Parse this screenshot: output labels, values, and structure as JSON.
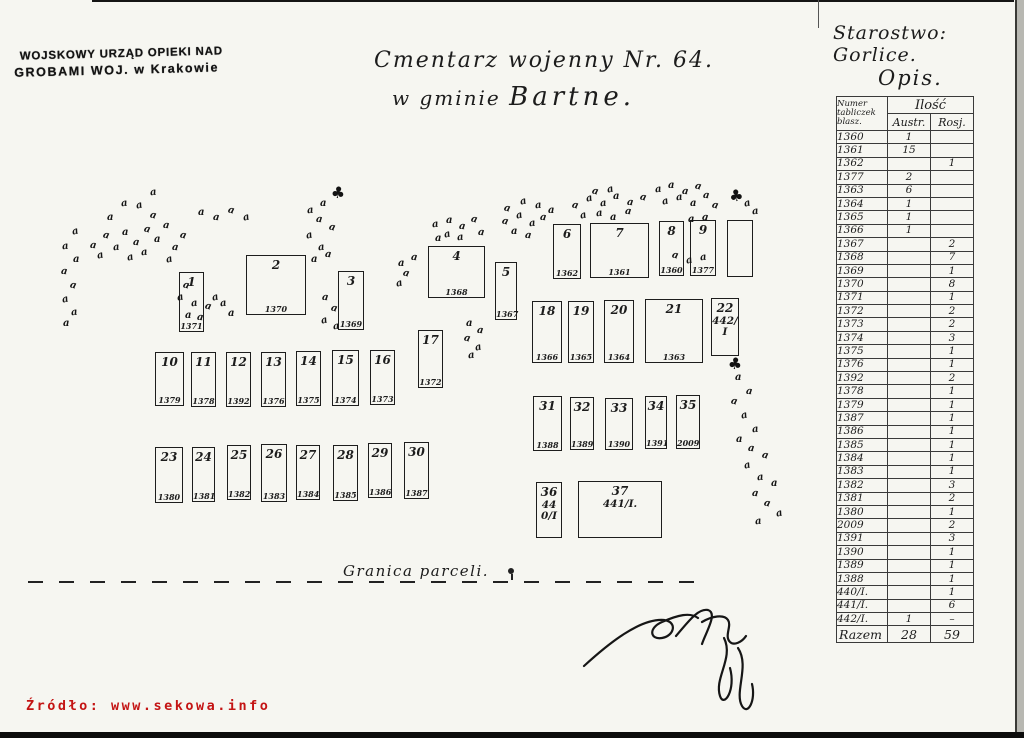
{
  "colors": {
    "paper": "#f6f6f1",
    "ink": "#1c1c1c",
    "accent_red": "#c41414"
  },
  "stamp": {
    "line1": "WOJSKOWY URZĄD OPIEKI NAD",
    "line2": "GROBAMI WOJ. w Krakowie"
  },
  "title": {
    "line1": "Cmentarz wojenny Nr. 64.",
    "line2_prefix": "w gminie",
    "line2_name": "Bartne."
  },
  "starostwo": "Starostwo: Gorlice.",
  "opis": {
    "label": "Opis.",
    "col_num": [
      "Numer",
      "tabliczek",
      "blasz."
    ],
    "col_ilosc": "Ilość",
    "col_austr": "Austr.",
    "col_ros": "Rosj.",
    "rows": [
      [
        "1360",
        "1",
        ""
      ],
      [
        "1361",
        "15",
        ""
      ],
      [
        "1362",
        "",
        "1"
      ],
      [
        "1377",
        "2",
        ""
      ],
      [
        "1363",
        "6",
        ""
      ],
      [
        "1364",
        "1",
        ""
      ],
      [
        "1365",
        "1",
        ""
      ],
      [
        "1366",
        "1",
        ""
      ],
      [
        "1367",
        "",
        "2"
      ],
      [
        "1368",
        "",
        "7"
      ],
      [
        "1369",
        "",
        "1"
      ],
      [
        "1370",
        "",
        "8"
      ],
      [
        "1371",
        "",
        "1"
      ],
      [
        "1372",
        "",
        "2"
      ],
      [
        "1373",
        "",
        "2"
      ],
      [
        "1374",
        "",
        "3"
      ],
      [
        "1375",
        "",
        "1"
      ],
      [
        "1376",
        "",
        "1"
      ],
      [
        "1392",
        "",
        "2"
      ],
      [
        "1378",
        "",
        "1"
      ],
      [
        "1379",
        "",
        "1"
      ],
      [
        "1387",
        "",
        "1"
      ],
      [
        "1386",
        "",
        "1"
      ],
      [
        "1385",
        "",
        "1"
      ],
      [
        "1384",
        "",
        "1"
      ],
      [
        "1383",
        "",
        "1"
      ],
      [
        "1382",
        "",
        "3"
      ],
      [
        "1381",
        "",
        "2"
      ],
      [
        "1380",
        "",
        "1"
      ],
      [
        "2009",
        "",
        "2"
      ],
      [
        "1391",
        "",
        "3"
      ],
      [
        "1390",
        "",
        "1"
      ],
      [
        "1389",
        "",
        "1"
      ],
      [
        "1388",
        "",
        "1"
      ],
      [
        "440/I.",
        "",
        "1"
      ],
      [
        "441/I.",
        "",
        "6"
      ],
      [
        "442/I.",
        "1",
        "–"
      ]
    ],
    "razem": [
      "Razem",
      "28",
      "59"
    ]
  },
  "map": {
    "granica": "Granica parceli.",
    "plots": [
      {
        "n": "1",
        "g": "1371",
        "x": 179,
        "y": 272,
        "w": 23,
        "h": 58
      },
      {
        "n": "2",
        "g": "1370",
        "x": 246,
        "y": 255,
        "w": 58,
        "h": 58
      },
      {
        "n": "3",
        "g": "1369",
        "x": 338,
        "y": 271,
        "w": 24,
        "h": 57
      },
      {
        "n": "4",
        "g": "1368",
        "x": 428,
        "y": 246,
        "w": 55,
        "h": 50
      },
      {
        "n": "5",
        "g": "1367",
        "x": 495,
        "y": 262,
        "w": 20,
        "h": 56
      },
      {
        "n": "6",
        "g": "1362",
        "x": 553,
        "y": 224,
        "w": 26,
        "h": 53
      },
      {
        "n": "7",
        "g": "1361",
        "x": 590,
        "y": 223,
        "w": 57,
        "h": 53
      },
      {
        "n": "8",
        "g": "1360",
        "x": 659,
        "y": 221,
        "w": 23,
        "h": 53
      },
      {
        "n": "9",
        "g": "1377",
        "x": 690,
        "y": 220,
        "w": 24,
        "h": 54
      },
      {
        "n": "",
        "g": "",
        "x": 727,
        "y": 220,
        "w": 24,
        "h": 55
      },
      {
        "n": "10",
        "g": "1379",
        "x": 155,
        "y": 352,
        "w": 27,
        "h": 52
      },
      {
        "n": "11",
        "g": "1378",
        "x": 191,
        "y": 352,
        "w": 23,
        "h": 53
      },
      {
        "n": "12",
        "g": "1392",
        "x": 226,
        "y": 352,
        "w": 23,
        "h": 53
      },
      {
        "n": "13",
        "g": "1376",
        "x": 261,
        "y": 352,
        "w": 23,
        "h": 53
      },
      {
        "n": "14",
        "g": "1375",
        "x": 296,
        "y": 351,
        "w": 23,
        "h": 53
      },
      {
        "n": "15",
        "g": "1374",
        "x": 332,
        "y": 350,
        "w": 25,
        "h": 54
      },
      {
        "n": "16",
        "g": "1373",
        "x": 370,
        "y": 350,
        "w": 23,
        "h": 53
      },
      {
        "n": "17",
        "g": "1372",
        "x": 418,
        "y": 330,
        "w": 23,
        "h": 56
      },
      {
        "n": "18",
        "g": "1366",
        "x": 532,
        "y": 301,
        "w": 28,
        "h": 60
      },
      {
        "n": "19",
        "g": "1365",
        "x": 568,
        "y": 301,
        "w": 24,
        "h": 60
      },
      {
        "n": "20",
        "g": "1364",
        "x": 604,
        "y": 300,
        "w": 28,
        "h": 61
      },
      {
        "n": "21",
        "g": "1363",
        "x": 645,
        "y": 299,
        "w": 56,
        "h": 62
      },
      {
        "n": "22",
        "g": "442/I",
        "x": 711,
        "y": 298,
        "w": 26,
        "h": 56,
        "gl": true
      },
      {
        "n": "23",
        "g": "1380",
        "x": 155,
        "y": 447,
        "w": 26,
        "h": 54
      },
      {
        "n": "24",
        "g": "1381",
        "x": 192,
        "y": 447,
        "w": 21,
        "h": 53
      },
      {
        "n": "25",
        "g": "1382",
        "x": 227,
        "y": 445,
        "w": 22,
        "h": 53
      },
      {
        "n": "26",
        "g": "1383",
        "x": 261,
        "y": 444,
        "w": 24,
        "h": 56
      },
      {
        "n": "27",
        "g": "1384",
        "x": 296,
        "y": 445,
        "w": 22,
        "h": 53
      },
      {
        "n": "28",
        "g": "1385",
        "x": 333,
        "y": 445,
        "w": 23,
        "h": 54
      },
      {
        "n": "29",
        "g": "1386",
        "x": 368,
        "y": 443,
        "w": 22,
        "h": 53
      },
      {
        "n": "30",
        "g": "1387",
        "x": 404,
        "y": 442,
        "w": 23,
        "h": 55
      },
      {
        "n": "31",
        "g": "1388",
        "x": 533,
        "y": 396,
        "w": 27,
        "h": 53
      },
      {
        "n": "32",
        "g": "1389",
        "x": 570,
        "y": 397,
        "w": 22,
        "h": 51
      },
      {
        "n": "33",
        "g": "1390",
        "x": 605,
        "y": 398,
        "w": 26,
        "h": 50
      },
      {
        "n": "34",
        "g": "1391",
        "x": 645,
        "y": 396,
        "w": 20,
        "h": 51
      },
      {
        "n": "35",
        "g": "2009",
        "x": 676,
        "y": 395,
        "w": 22,
        "h": 52
      },
      {
        "n": "36",
        "g": "440/I",
        "x": 536,
        "y": 482,
        "w": 24,
        "h": 54,
        "gl": true
      },
      {
        "n": "37",
        "g": "441/I.",
        "x": 578,
        "y": 481,
        "w": 82,
        "h": 55,
        "gl": true
      }
    ],
    "tree_glyph": "a",
    "big_tree_glyph": "♣",
    "trees": [
      [
        72,
        226
      ],
      [
        62,
        241
      ],
      [
        73,
        254
      ],
      [
        61,
        266
      ],
      [
        70,
        280
      ],
      [
        62,
        294
      ],
      [
        71,
        307
      ],
      [
        63,
        318
      ],
      [
        90,
        240
      ],
      [
        103,
        230
      ],
      [
        97,
        250
      ],
      [
        113,
        242
      ],
      [
        122,
        227
      ],
      [
        133,
        237
      ],
      [
        144,
        224
      ],
      [
        127,
        252
      ],
      [
        141,
        247
      ],
      [
        154,
        234
      ],
      [
        163,
        220
      ],
      [
        150,
        210
      ],
      [
        136,
        200
      ],
      [
        121,
        198
      ],
      [
        107,
        212
      ],
      [
        172,
        242
      ],
      [
        180,
        230
      ],
      [
        166,
        254
      ],
      [
        150,
        187
      ],
      [
        198,
        207
      ],
      [
        213,
        212
      ],
      [
        228,
        205
      ],
      [
        243,
        212
      ],
      [
        307,
        205
      ],
      [
        320,
        198
      ],
      [
        316,
        214
      ],
      [
        329,
        222
      ],
      [
        306,
        230
      ],
      [
        318,
        242
      ],
      [
        311,
        254
      ],
      [
        325,
        249
      ],
      [
        183,
        280
      ],
      [
        177,
        292
      ],
      [
        191,
        298
      ],
      [
        185,
        310
      ],
      [
        197,
        312
      ],
      [
        205,
        301
      ],
      [
        212,
        292
      ],
      [
        220,
        298
      ],
      [
        228,
        308
      ],
      [
        322,
        292
      ],
      [
        331,
        303
      ],
      [
        321,
        315
      ],
      [
        333,
        321
      ],
      [
        398,
        258
      ],
      [
        411,
        252
      ],
      [
        403,
        268
      ],
      [
        396,
        278
      ],
      [
        432,
        219
      ],
      [
        446,
        215
      ],
      [
        459,
        221
      ],
      [
        471,
        214
      ],
      [
        444,
        229
      ],
      [
        457,
        232
      ],
      [
        435,
        233
      ],
      [
        478,
        227
      ],
      [
        502,
        216
      ],
      [
        516,
        210
      ],
      [
        529,
        218
      ],
      [
        511,
        226
      ],
      [
        525,
        230
      ],
      [
        504,
        203
      ],
      [
        520,
        196
      ],
      [
        535,
        200
      ],
      [
        548,
        205
      ],
      [
        540,
        212
      ],
      [
        572,
        200
      ],
      [
        586,
        193
      ],
      [
        600,
        198
      ],
      [
        613,
        191
      ],
      [
        627,
        197
      ],
      [
        640,
        192
      ],
      [
        580,
        210
      ],
      [
        596,
        208
      ],
      [
        610,
        212
      ],
      [
        625,
        206
      ],
      [
        592,
        186
      ],
      [
        607,
        184
      ],
      [
        655,
        184
      ],
      [
        668,
        180
      ],
      [
        682,
        186
      ],
      [
        695,
        181
      ],
      [
        662,
        196
      ],
      [
        676,
        192
      ],
      [
        690,
        198
      ],
      [
        703,
        190
      ],
      [
        672,
        250
      ],
      [
        686,
        255
      ],
      [
        700,
        252
      ],
      [
        688,
        214
      ],
      [
        702,
        212
      ],
      [
        712,
        200
      ],
      [
        744,
        198
      ],
      [
        752,
        206
      ],
      [
        466,
        318
      ],
      [
        477,
        325
      ],
      [
        464,
        333
      ],
      [
        475,
        342
      ],
      [
        468,
        350
      ],
      [
        735,
        372
      ],
      [
        746,
        386
      ],
      [
        731,
        396
      ],
      [
        741,
        410
      ],
      [
        752,
        424
      ],
      [
        736,
        434
      ],
      [
        748,
        443
      ],
      [
        762,
        450
      ],
      [
        744,
        460
      ],
      [
        757,
        472
      ],
      [
        771,
        478
      ],
      [
        752,
        488
      ],
      [
        764,
        498
      ],
      [
        776,
        508
      ],
      [
        755,
        516
      ]
    ],
    "big_trees": [
      [
        331,
        183
      ],
      [
        729,
        186
      ],
      [
        728,
        354
      ]
    ]
  },
  "source": "Źródło: www.sekowa.info"
}
